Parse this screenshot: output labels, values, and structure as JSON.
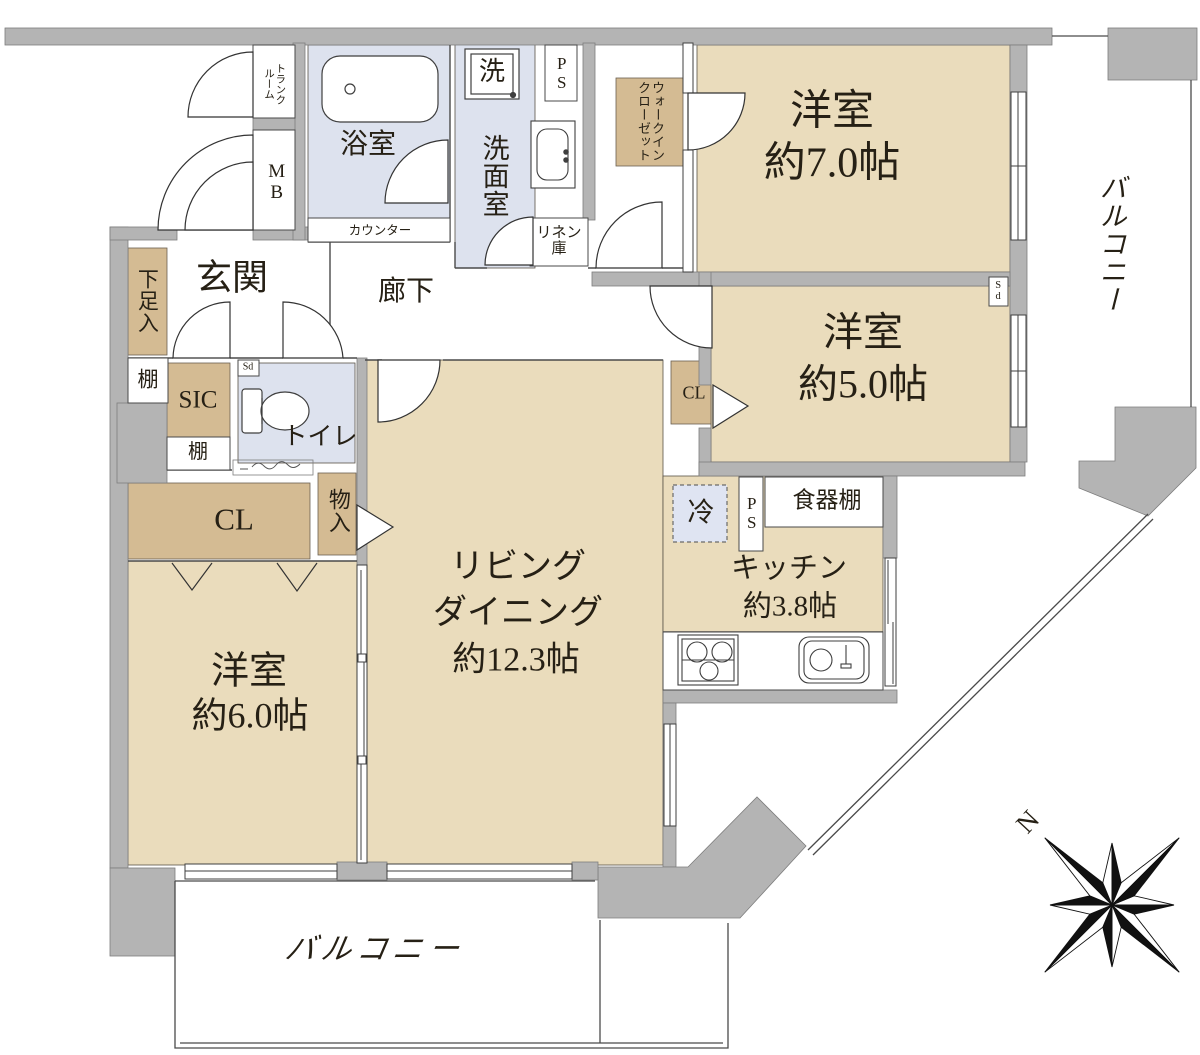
{
  "colors": {
    "room_fill": "#eadcbc",
    "closet_fill": "#d4bb93",
    "wet_fill": "#dde2ee",
    "wall_fill": "#b4b4b4"
  },
  "rooms": {
    "bedroom7": {
      "name": "洋室",
      "size": "約7.0帖"
    },
    "bedroom5": {
      "name": "洋室",
      "size": "約5.0帖"
    },
    "bedroom6": {
      "name": "洋室",
      "size": "約6.0帖"
    },
    "living": {
      "name1": "リビング",
      "name2": "ダイニング",
      "size": "約12.3帖"
    },
    "kitchen": {
      "name": "キッチン",
      "size": "約3.8帖"
    },
    "bath": {
      "name": "浴室"
    },
    "washroom": {
      "name": "洗面室"
    },
    "toilet": {
      "name": "トイレ"
    },
    "entrance": {
      "name": "玄関"
    },
    "hallway": {
      "name": "廊下"
    },
    "balcony_right": {
      "name": "バルコニー"
    },
    "balcony_bottom": {
      "name": "バルコニー"
    }
  },
  "storage": {
    "walk_in_closet": "ウォークインクローゼット",
    "trunk_room": "トランクルーム",
    "shoe_cabinet": "下足入",
    "shelf_upper": "棚",
    "shelf_lower": "棚",
    "shoe_in_closet": "SIC",
    "closet_bedroom6": "CL",
    "closet_bedroom5": "CL",
    "storage_compartment": "物入",
    "linen_cabinet": "リネン庫",
    "cupboard": "食器棚"
  },
  "fixtures": {
    "meter_box": "MB",
    "pipe_space_top": "PS",
    "pipe_space_kitchen": "PS",
    "washer": "洗",
    "refrigerator": "冷",
    "counter": "カウンター",
    "detector_toilet": "Sd",
    "detector_bedroom5": "Sd"
  },
  "compass": {
    "north": "N"
  }
}
